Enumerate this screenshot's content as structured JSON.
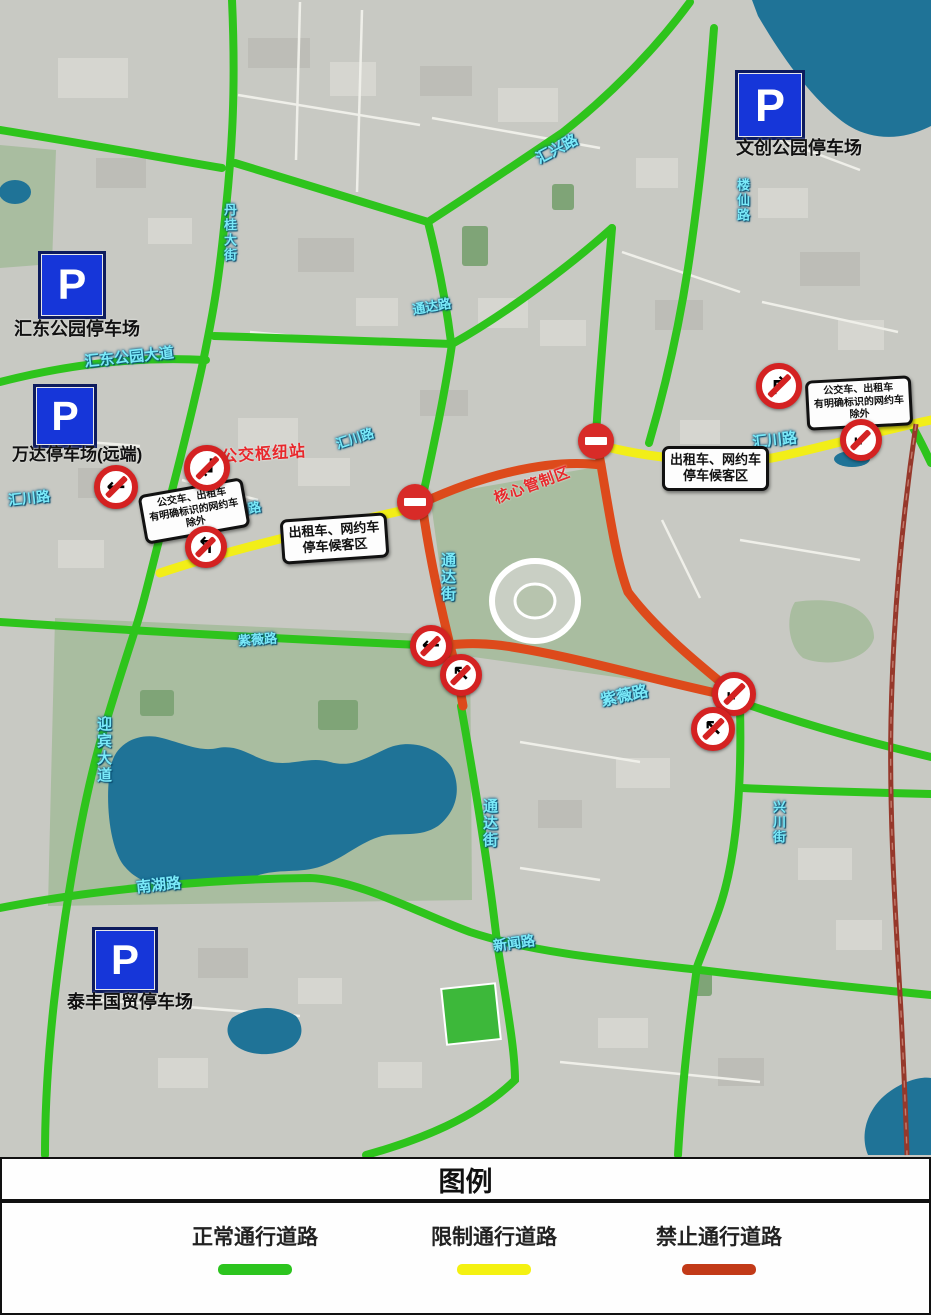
{
  "legend": {
    "title": "图例",
    "items": [
      {
        "label": "正常通行道路",
        "color": "#2cc41e"
      },
      {
        "label": "限制通行道路",
        "color": "#f4f111"
      },
      {
        "label": "禁止通行道路",
        "color": "#c23a18"
      }
    ],
    "centers": [
      253,
      492,
      717
    ]
  },
  "parking_lots": [
    {
      "name": "文创公园停车场",
      "sx": 735,
      "sy": 70,
      "size": 64,
      "lx": 736,
      "ly": 134,
      "lsize": 18
    },
    {
      "name": "汇东公园停车场",
      "sx": 38,
      "sy": 251,
      "size": 62,
      "lx": 14,
      "ly": 315,
      "lsize": 18
    },
    {
      "name": "万达停车场(远端)",
      "sx": 33,
      "sy": 384,
      "size": 58,
      "lx": 12,
      "ly": 440,
      "lsize": 17
    },
    {
      "name": "泰丰国贸停车场",
      "sx": 92,
      "sy": 927,
      "size": 60,
      "lx": 67,
      "ly": 988,
      "lsize": 18
    }
  ],
  "zone_labels": [
    {
      "text": "公交枢纽站",
      "x": 221,
      "y": 440,
      "size": 16,
      "rot": -4,
      "color": "#e8282c"
    },
    {
      "text": "核心管制区",
      "x": 492,
      "y": 474,
      "size": 15,
      "rot": -20,
      "color": "#e8282c"
    }
  ],
  "notice_boxes": [
    {
      "lines": [
        "公交车、出租车",
        "有明确标识的网约车",
        "除外"
      ],
      "x": 141,
      "y": 486,
      "rot": -10,
      "size": 10
    },
    {
      "lines": [
        "出租车、网约车",
        "停车候客区"
      ],
      "x": 281,
      "y": 516,
      "rot": -4,
      "size": 13
    },
    {
      "lines": [
        "出租车、网约车",
        "停车候客区"
      ],
      "x": 662,
      "y": 446,
      "rot": 0,
      "size": 13
    },
    {
      "lines": [
        "公交车、出租车",
        "有明确标识的网约车",
        "除外"
      ],
      "x": 806,
      "y": 378,
      "rot": -3,
      "size": 10
    }
  ],
  "road_labels": [
    {
      "text": "汇兴路",
      "x": 534,
      "y": 138,
      "size": 15,
      "rot": -28,
      "vertical": false
    },
    {
      "text": "楼仙路",
      "x": 733,
      "y": 178,
      "size": 13,
      "rot": 0,
      "vertical": true
    },
    {
      "text": "丹桂大街",
      "x": 220,
      "y": 203,
      "size": 13,
      "rot": 0,
      "vertical": true
    },
    {
      "text": "汇东公园大道",
      "x": 84,
      "y": 346,
      "size": 15,
      "rot": -6,
      "vertical": false
    },
    {
      "text": "通达路",
      "x": 412,
      "y": 296,
      "size": 13,
      "rot": -10,
      "vertical": false
    },
    {
      "text": "汇川路",
      "x": 8,
      "y": 488,
      "size": 14,
      "rot": -6,
      "vertical": false
    },
    {
      "text": "汇川路",
      "x": 222,
      "y": 500,
      "size": 13,
      "rot": -12,
      "vertical": false
    },
    {
      "text": "汇川路",
      "x": 335,
      "y": 428,
      "size": 13,
      "rot": -18,
      "vertical": false
    },
    {
      "text": "汇川路",
      "x": 752,
      "y": 429,
      "size": 15,
      "rot": -6,
      "vertical": false
    },
    {
      "text": "通达街",
      "x": 437,
      "y": 552,
      "size": 15,
      "rot": 0,
      "vertical": true
    },
    {
      "text": "通达街",
      "x": 479,
      "y": 798,
      "size": 15,
      "rot": 0,
      "vertical": true
    },
    {
      "text": "紫薇路",
      "x": 600,
      "y": 682,
      "size": 16,
      "rot": -12,
      "vertical": false
    },
    {
      "text": "紫薇路",
      "x": 238,
      "y": 629,
      "size": 13,
      "rot": -4,
      "vertical": false
    },
    {
      "text": "迎宾大道",
      "x": 93,
      "y": 716,
      "size": 15,
      "rot": 0,
      "vertical": true
    },
    {
      "text": "南湖路",
      "x": 136,
      "y": 874,
      "size": 15,
      "rot": -6,
      "vertical": false
    },
    {
      "text": "新闻路",
      "x": 493,
      "y": 933,
      "size": 14,
      "rot": -8,
      "vertical": false
    },
    {
      "text": "兴川街",
      "x": 769,
      "y": 800,
      "size": 13,
      "rot": 0,
      "vertical": true
    }
  ],
  "signs": [
    {
      "type": "no-turn",
      "name": "no-left-turn-sign",
      "x": 116,
      "y": 487,
      "d": 44,
      "glyph": "←"
    },
    {
      "type": "no-turn",
      "name": "no-turn-sign",
      "x": 207,
      "y": 468,
      "d": 46,
      "glyph": "↲"
    },
    {
      "type": "no-turn",
      "name": "no-turn-sign",
      "x": 206,
      "y": 547,
      "d": 42,
      "glyph": "↰"
    },
    {
      "type": "no-entry",
      "name": "no-entry-sign",
      "x": 415,
      "y": 502,
      "d": 36
    },
    {
      "type": "no-entry",
      "name": "no-entry-sign",
      "x": 596,
      "y": 441,
      "d": 36
    },
    {
      "type": "no-turn",
      "name": "no-right-turn-sign",
      "x": 779,
      "y": 386,
      "d": 46,
      "glyph": "↱"
    },
    {
      "type": "no-turn",
      "name": "no-turn-sign",
      "x": 861,
      "y": 440,
      "d": 42,
      "glyph": "↙"
    },
    {
      "type": "no-turn",
      "name": "no-turn-sign",
      "x": 431,
      "y": 646,
      "d": 42,
      "glyph": "←"
    },
    {
      "type": "no-turn",
      "name": "no-turn-sign",
      "x": 461,
      "y": 675,
      "d": 42,
      "glyph": "↖"
    },
    {
      "type": "no-turn",
      "name": "no-turn-sign",
      "x": 734,
      "y": 694,
      "d": 44,
      "glyph": "↙"
    },
    {
      "type": "no-turn",
      "name": "no-turn-sign",
      "x": 713,
      "y": 729,
      "d": 44,
      "glyph": "↖"
    }
  ],
  "map": {
    "width": 931,
    "height": 1157,
    "colors": {
      "base": "#c8c9c3",
      "water": "#1f7397",
      "park": "#a9bda0",
      "park_dark": "#7fa477",
      "road_normal": "#2ec41c",
      "road_restricted": "#f2ee18",
      "road_prohibited": "#dd4a1b",
      "railway": "#96382b",
      "building": "#d6d6d0",
      "building_dark": "#bdbdb7",
      "street": "#efefe9",
      "pitch": "#3db83a"
    },
    "roads": {
      "normal": [
        "M232,0 C236,90 232,150 226,208 C218,292 211,322 203,362 C191,418 174,484 157,548 C147,588 141,612 135,630 C121,674 107,716 97,754 C81,814 65,906 54,1002 C47,1066 45,1112 45,1155",
        "M0,130 C75,142 152,156 222,168",
        "M0,382 C62,366 132,356 206,360",
        "M235,163 C298,182 368,204 428,222",
        "M428,222 C470,195 522,160 562,133 C602,102 652,54 690,2",
        "M428,222 C438,262 446,302 451,342",
        "M214,336 C292,338 380,342 452,344",
        "M452,344 C506,314 572,264 612,228",
        "M612,228 C606,300 599,380 596,436",
        "M452,344 C444,400 430,462 422,500",
        "M714,28 C707,120 698,202 688,268 C678,332 664,392 649,443",
        "M0,622 C140,631 300,640 444,646",
        "M461,706 C476,790 489,872 497,942",
        "M0,908 C90,890 210,879 310,878 C360,880 420,914 470,932 C530,952 610,960 700,970 C800,982 870,989 931,995",
        "M740,707 C742,790 736,862 718,912 C707,942 700,958 697,967 C688,1032 681,1102 678,1155",
        "M497,942 C507,1008 515,1050 515,1080 C476,1118 420,1140 366,1155",
        "M742,788 C812,791 882,793 931,794",
        "M743,703 C812,727 872,743 931,757",
        "M904,412 C915,430 924,448 931,463"
      ],
      "restricted": [
        "M160,573 C232,549 322,528 419,507",
        "M599,445 C652,459 722,465 772,458 C822,448 882,430 931,420"
      ],
      "prohibited": [
        "M422,503 C478,477 546,458 601,465 C611,524 617,563 628,592 C656,630 702,667 740,698 C672,685 582,658 512,647 C489,643 466,643 450,645 C439,600 428,550 422,503 Z",
        "M450,645 C456,668 460,688 463,706",
        "M601,465 L597,444"
      ],
      "railway": [
        "M916,424 C902,520 893,620 891,720 C889,822 896,922 901,1012 C904,1072 906,1122 907,1155"
      ]
    },
    "water": [
      "M752,0 L931,0 L931,126 C898,143 864,140 838,118 C806,92 778,50 758,16 Z",
      "M112,762 C118,742 140,732 162,738 C185,744 200,752 218,748 C240,744 252,758 272,762 C292,766 310,756 330,762 C352,768 366,758 388,748 C412,738 440,748 452,768 C462,790 456,812 438,826 C420,838 400,832 382,836 C360,842 344,858 322,866 C300,874 278,868 256,876 C234,884 210,878 188,884 C166,890 140,884 126,868 C108,850 104,790 112,762 Z",
      "M232,1018 C250,1006 278,1004 296,1016 C306,1028 302,1044 286,1050 C266,1058 242,1054 232,1042 C226,1034 226,1026 232,1018 Z",
      "M884,1096 C900,1082 920,1076 931,1078 L931,1155 L868,1155 C860,1136 866,1112 884,1096 Z"
    ],
    "ponds": [
      {
        "cx": 15,
        "cy": 192,
        "rx": 16,
        "ry": 12
      },
      {
        "cx": 852,
        "cy": 459,
        "rx": 18,
        "ry": 8
      }
    ],
    "parks": [
      "M55,618 L470,636 L472,900 L48,906 Z",
      "M430,496 L602,466 L626,592 L736,694 L452,654 Z",
      "M0,145 L56,150 L52,264 L0,268 Z",
      "M795,602 C842,595 874,610 874,638 C868,661 828,668 803,658 C787,645 786,615 795,602 Z"
    ],
    "trees": [
      {
        "x": 462,
        "y": 226,
        "w": 26,
        "h": 40
      },
      {
        "x": 552,
        "y": 184,
        "w": 22,
        "h": 26
      },
      {
        "x": 318,
        "y": 700,
        "w": 40,
        "h": 30
      },
      {
        "x": 140,
        "y": 690,
        "w": 34,
        "h": 26
      },
      {
        "x": 692,
        "y": 972,
        "w": 20,
        "h": 24
      },
      {
        "x": 200,
        "y": 812,
        "w": 26,
        "h": 20
      }
    ],
    "buildings": [
      {
        "x": 248,
        "y": 38,
        "w": 62,
        "h": 30
      },
      {
        "x": 330,
        "y": 62,
        "w": 46,
        "h": 34
      },
      {
        "x": 58,
        "y": 58,
        "w": 70,
        "h": 40
      },
      {
        "x": 420,
        "y": 66,
        "w": 52,
        "h": 30
      },
      {
        "x": 498,
        "y": 88,
        "w": 60,
        "h": 34
      },
      {
        "x": 758,
        "y": 188,
        "w": 50,
        "h": 30
      },
      {
        "x": 800,
        "y": 252,
        "w": 60,
        "h": 34
      },
      {
        "x": 838,
        "y": 320,
        "w": 46,
        "h": 30
      },
      {
        "x": 636,
        "y": 158,
        "w": 42,
        "h": 30
      },
      {
        "x": 298,
        "y": 238,
        "w": 56,
        "h": 34
      },
      {
        "x": 356,
        "y": 298,
        "w": 42,
        "h": 28
      },
      {
        "x": 478,
        "y": 298,
        "w": 50,
        "h": 30
      },
      {
        "x": 655,
        "y": 300,
        "w": 48,
        "h": 30
      },
      {
        "x": 238,
        "y": 418,
        "w": 60,
        "h": 30
      },
      {
        "x": 298,
        "y": 458,
        "w": 52,
        "h": 28
      },
      {
        "x": 78,
        "y": 468,
        "w": 50,
        "h": 30
      },
      {
        "x": 58,
        "y": 540,
        "w": 46,
        "h": 28
      },
      {
        "x": 616,
        "y": 758,
        "w": 54,
        "h": 30
      },
      {
        "x": 538,
        "y": 800,
        "w": 44,
        "h": 28
      },
      {
        "x": 798,
        "y": 848,
        "w": 54,
        "h": 32
      },
      {
        "x": 836,
        "y": 920,
        "w": 46,
        "h": 30
      },
      {
        "x": 198,
        "y": 948,
        "w": 50,
        "h": 30
      },
      {
        "x": 298,
        "y": 978,
        "w": 44,
        "h": 26
      },
      {
        "x": 598,
        "y": 1018,
        "w": 50,
        "h": 30
      },
      {
        "x": 718,
        "y": 1058,
        "w": 46,
        "h": 28
      },
      {
        "x": 158,
        "y": 1058,
        "w": 50,
        "h": 30
      },
      {
        "x": 378,
        "y": 1062,
        "w": 44,
        "h": 26
      },
      {
        "x": 96,
        "y": 158,
        "w": 50,
        "h": 30
      },
      {
        "x": 148,
        "y": 218,
        "w": 44,
        "h": 26
      },
      {
        "x": 540,
        "y": 320,
        "w": 46,
        "h": 26
      },
      {
        "x": 420,
        "y": 390,
        "w": 48,
        "h": 26
      },
      {
        "x": 680,
        "y": 420,
        "w": 40,
        "h": 24
      }
    ],
    "streets": [
      "238,95 420,125",
      "300,2 296,160",
      "362,10 357,192",
      "432,118 600,148",
      "622,252 740,292",
      "762,302 898,332",
      "60,440 140,446",
      "520,742 640,762",
      "100,1000 300,1016",
      "560,1062 760,1082",
      "182,480 258,500",
      "662,520 700,598",
      "250,332 350,341",
      "740,540 860,560",
      "780,140 860,170",
      "520,868 600,880"
    ],
    "stadium": {
      "cx": 535,
      "cy": 601,
      "rx": 43,
      "ry": 40
    },
    "pitch": {
      "x": 444,
      "y": 986,
      "w": 54,
      "h": 56,
      "rot": -6
    }
  }
}
